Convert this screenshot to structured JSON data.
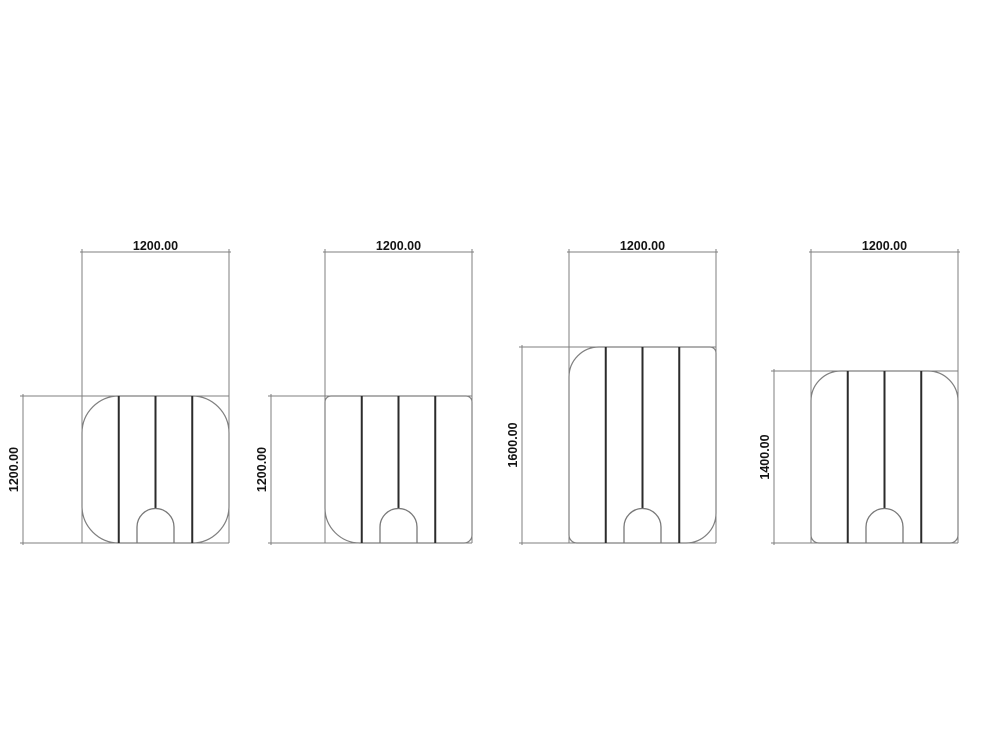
{
  "canvas": {
    "width": 1000,
    "height": 755,
    "background": "#ffffff"
  },
  "style": {
    "outline_color": "#7f7f7f",
    "dim_line_color": "#7f7f7f",
    "seam_color": "#2b2b2b",
    "arch_color": "#787878",
    "text_color": "#141414"
  },
  "features": {
    "seam_fractions": [
      0.25,
      0.5,
      0.75
    ],
    "arch": {
      "half_width": 18.5,
      "side_height": 16,
      "radius": 18.5
    }
  },
  "drawings": [
    {
      "id": "cover-pattern-1",
      "top_dimension": {
        "label": "1200.00"
      },
      "side_dimension": {
        "label": "1200.00"
      },
      "geometry": {
        "left": 82,
        "right": 229,
        "top": 396,
        "bottom": 543,
        "top_dim_y": 252,
        "side_dim_x": 23,
        "radii": {
          "tl": 37,
          "tr": 37,
          "br": 37,
          "bl": 37
        }
      }
    },
    {
      "id": "cover-pattern-2",
      "top_dimension": {
        "label": "1200.00"
      },
      "side_dimension": {
        "label": "1200.00"
      },
      "geometry": {
        "left": 325,
        "right": 472,
        "top": 396,
        "bottom": 543,
        "top_dim_y": 252,
        "side_dim_x": 271,
        "radii": {
          "tl": 6,
          "tr": 6,
          "br": 8,
          "bl": 35
        }
      }
    },
    {
      "id": "cover-pattern-3",
      "top_dimension": {
        "label": "1200.00"
      },
      "side_dimension": {
        "label": "1600.00"
      },
      "geometry": {
        "left": 569,
        "right": 716,
        "top": 347,
        "bottom": 543,
        "top_dim_y": 252,
        "side_dim_x": 522,
        "radii": {
          "tl": 30,
          "tr": 6,
          "br": 30,
          "bl": 8
        }
      }
    },
    {
      "id": "cover-pattern-4",
      "top_dimension": {
        "label": "1200.00"
      },
      "side_dimension": {
        "label": "1400.00"
      },
      "geometry": {
        "left": 811,
        "right": 958,
        "top": 371,
        "bottom": 543,
        "top_dim_y": 252,
        "side_dim_x": 774,
        "radii": {
          "tl": 30,
          "tr": 30,
          "br": 8,
          "bl": 8
        }
      }
    }
  ]
}
